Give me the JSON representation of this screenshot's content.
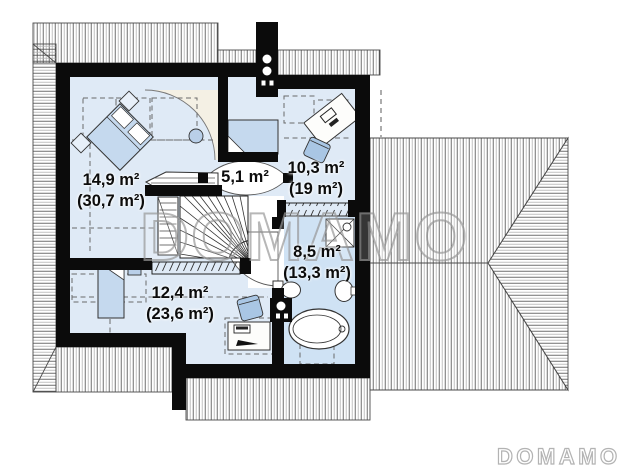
{
  "plan": {
    "kind": "floor-plan",
    "rooms": [
      {
        "name": "room-left-bedroom",
        "area": "14,9 m²",
        "area_total": "(30,7 m²)"
      },
      {
        "name": "room-hall",
        "area": "5,1 m²",
        "area_total": ""
      },
      {
        "name": "room-right-bedroom",
        "area": "10,3 m²",
        "area_total": "(19 m²)"
      },
      {
        "name": "room-bathroom",
        "area": "8,5 m²",
        "area_total": "(13,3 m²)"
      },
      {
        "name": "room-bottom-bedroom",
        "area": "12,4 m²",
        "area_total": "(23,6 m²)"
      }
    ],
    "fixtures": [
      "double-bed",
      "single-bed",
      "bed",
      "nightstand",
      "pouf",
      "desk",
      "chair",
      "wardrobe",
      "shelf",
      "staircase",
      "bathtub",
      "shower",
      "toilet",
      "sink",
      "chimney",
      "roof"
    ],
    "colors": {
      "floor": "#dfeaf6",
      "bathroom_floor": "#cfe2f4",
      "furniture_blue": "#c5d9ee",
      "chair_blue": "#a9c6e4",
      "door_zone_cream": "#f4f0e4",
      "wall": "#0b0b0b",
      "roof_line_dark": "#4a4a4a",
      "roof_line_light": "#b0b0b0",
      "watermark_large": "#999999",
      "watermark_small": "#b3b3b3"
    }
  },
  "watermark": {
    "large": "DOMAMO",
    "small": "DOMAMO"
  }
}
